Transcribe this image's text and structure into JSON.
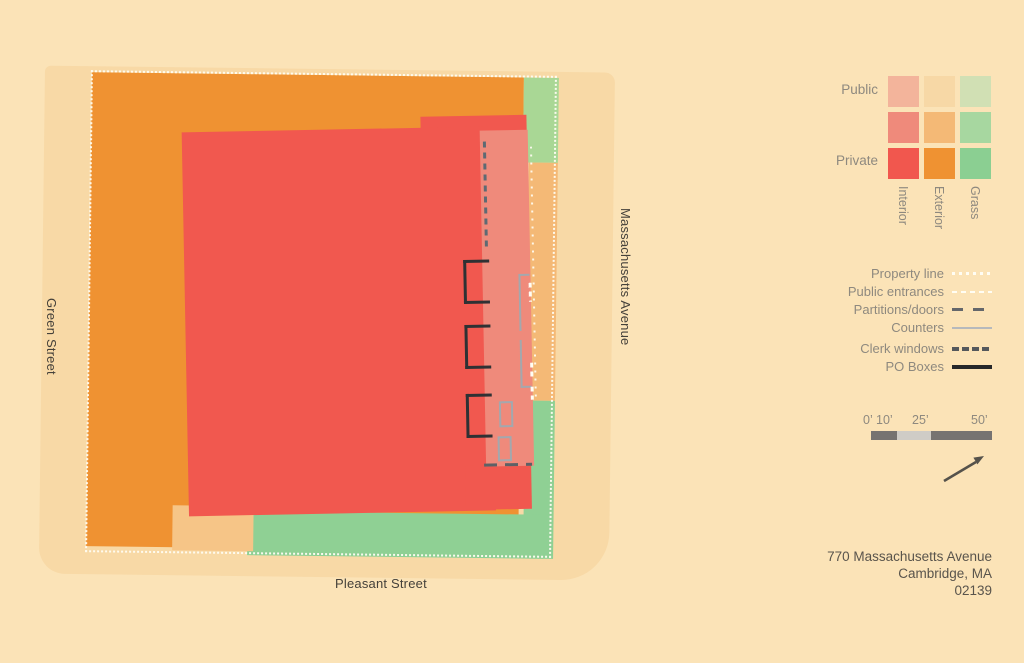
{
  "map": {
    "streets": {
      "left": "Green Street",
      "right": "Massachusetts Avenue",
      "bottom": "Pleasant Street"
    }
  },
  "legend": {
    "matrix": {
      "row_labels": [
        "Public",
        "Private"
      ],
      "col_labels": [
        "Interior",
        "Exterior",
        "Grass"
      ],
      "colors": [
        [
          "#F3B49B",
          "#F7D8A6",
          "#D1E0B4"
        ],
        [
          "#EF8A7B",
          "#F4B976",
          "#A7D7A0"
        ],
        [
          "#F1574E",
          "#EF9232",
          "#8BCF92"
        ]
      ]
    },
    "lines": [
      {
        "label": "Property line",
        "style": "dotted-white"
      },
      {
        "label": "Public entrances",
        "style": "dashed-white"
      },
      {
        "label": "Partitions/doors",
        "style": "long-dashed-dark"
      },
      {
        "label": "Counters",
        "style": "thin-solid-gray"
      },
      {
        "label": "Clerk windows",
        "style": "thick-dashed-dark"
      },
      {
        "label": "PO Boxes",
        "style": "thick-solid-black"
      }
    ]
  },
  "scale_bar": {
    "labels": [
      "0’",
      "10’",
      "25’",
      "50’"
    ],
    "segment_colors": [
      "#767371",
      "#CFCCC6",
      "#767371"
    ]
  },
  "north_arrow": "northeast",
  "address": {
    "line1": "770 Massachusetts Avenue",
    "line2": "Cambridge, MA",
    "line3": "02139"
  },
  "colors": {
    "page_bg": "#FBE3B7",
    "public_exterior_sidewalk": "#F8D9A6",
    "private_exterior_orange": "#EF9232",
    "semi_exterior_orange": "#F4B976",
    "semi_exterior_tan": "#F6C587",
    "private_interior_red": "#F1584F",
    "semi_interior_salmon": "#EF8A7B",
    "semi_grass_green": "#A9D795",
    "private_grass_green": "#8FD094"
  }
}
